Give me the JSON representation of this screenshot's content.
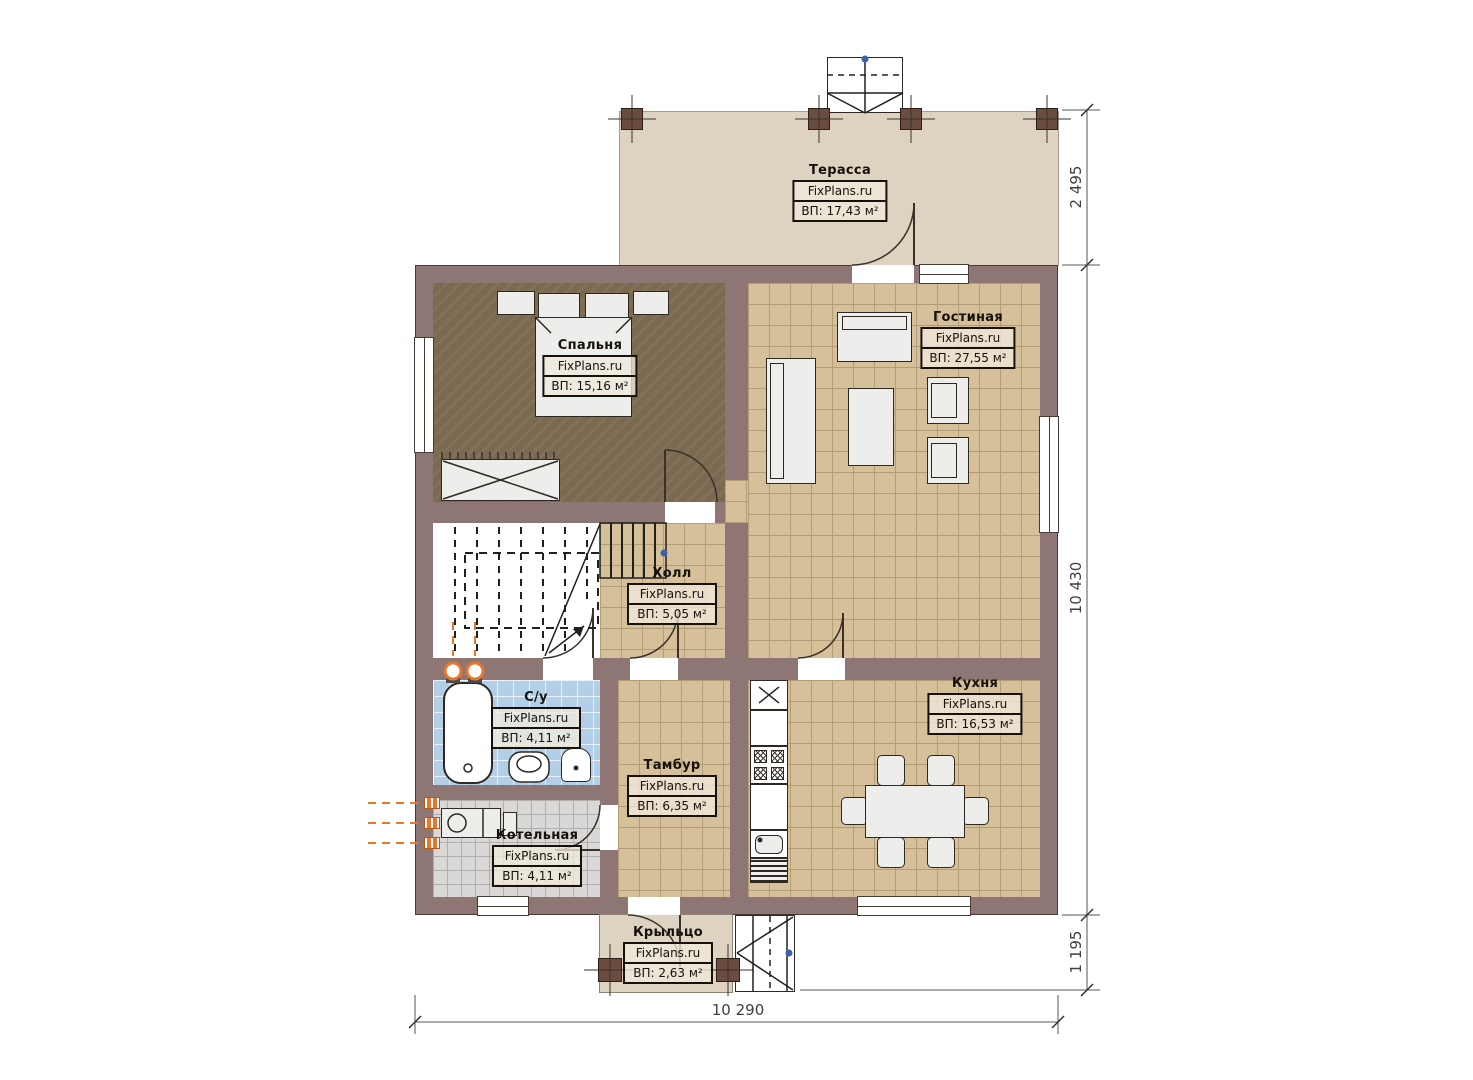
{
  "watermark": "FixPlans.ru",
  "rooms": {
    "terrace": {
      "name": "Терасса",
      "area": "ВП: 17,43 м²"
    },
    "bedroom": {
      "name": "Спальня",
      "area": "ВП: 15,16 м²"
    },
    "living": {
      "name": "Гостиная",
      "area": "ВП: 27,55 м²"
    },
    "hall": {
      "name": "Холл",
      "area": "ВП: 5,05 м²"
    },
    "bathroom": {
      "name": "С/у",
      "area": "ВП: 4,11 м²"
    },
    "tambour": {
      "name": "Тамбур",
      "area": "ВП: 6,35 м²"
    },
    "kitchen": {
      "name": "Кухня",
      "area": "ВП: 16,53 м²"
    },
    "boiler": {
      "name": "Котельная",
      "area": "ВП: 4,11 м²"
    },
    "porch": {
      "name": "Крыльцо",
      "area": "ВП: 2,63 м²"
    }
  },
  "dimensions": {
    "terrace_depth": "2 495",
    "house_length": "10 430",
    "porch_depth": "1 195",
    "house_width": "10 290"
  },
  "colors": {
    "wall": "#8d7674",
    "wall-line": "#463c35",
    "tan": "#d5c099",
    "tan-line": "#b39d76",
    "bedroom": "#7b6950",
    "bath": "#b3cfe7",
    "bath-line": "#e8f1f8",
    "boiler": "#d9d8d6",
    "boiler-line": "#b0afad",
    "terrace": "#ded3c1",
    "furniture": "#ededeb",
    "line": "#2e2822",
    "radiator": "#e8762b",
    "dim": "#3f3f3f",
    "blue-dot": "#3a62a8"
  }
}
